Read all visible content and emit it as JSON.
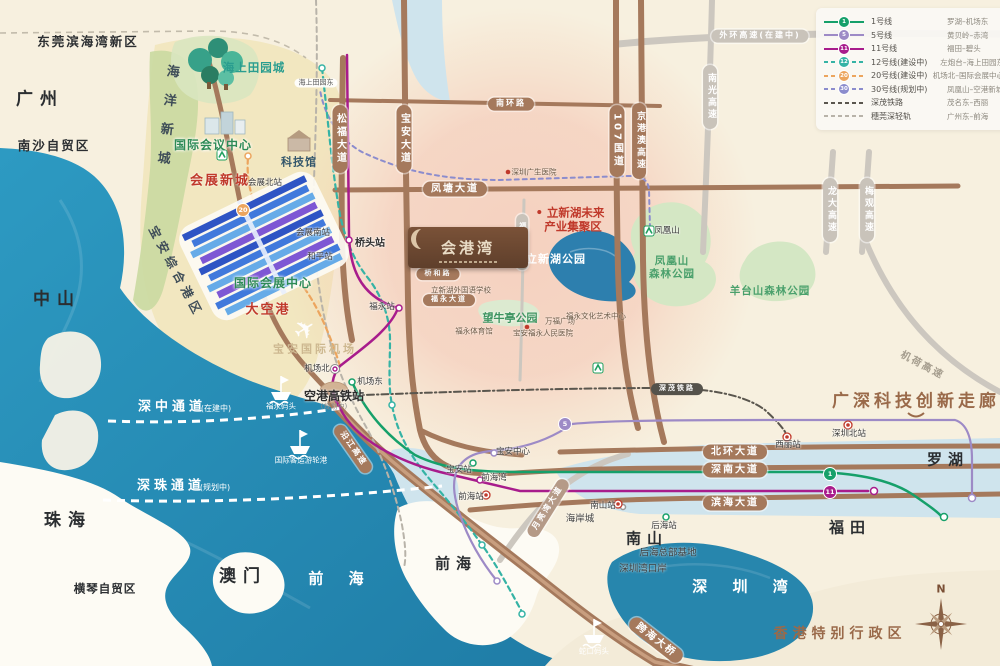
{
  "colors": {
    "sea": "#2b93bb",
    "bay": "#2786ad",
    "land": "#f7f0df",
    "road_brown": "#a5795c",
    "road_gray": "#c9c3ba",
    "pink_zone": "#f3b2a0",
    "green_zone": "#cbdaa2",
    "accent_red": "#c0392b"
  },
  "logo": {
    "title": "会港湾"
  },
  "legend": {
    "rows": [
      {
        "num": "1",
        "name": "1号线",
        "route": "罗湖–机场东",
        "color": "#16a06a",
        "dash": false
      },
      {
        "num": "5",
        "name": "5号线",
        "route": "黄贝岭–赤湾",
        "color": "#9d8ac6",
        "dash": false
      },
      {
        "num": "11",
        "name": "11号线",
        "route": "福田–碧头",
        "color": "#a81c8c",
        "dash": false
      },
      {
        "num": "12",
        "name": "12号线(建设中)",
        "route": "左炮台–海上田园东",
        "color": "#35b3a5",
        "dash": true
      },
      {
        "num": "20",
        "name": "20号线(建设中)",
        "route": "机场北–国际会展中心",
        "color": "#eca55e",
        "dash": true
      },
      {
        "num": "30",
        "name": "30号线(规划中)",
        "route": "凤凰山–空港新城",
        "color": "#8b8ccd",
        "dash": true
      },
      {
        "num": null,
        "name": "深茂铁路",
        "route": "茂名东–西丽",
        "color": "#5a564e",
        "dash": true
      },
      {
        "num": null,
        "name": "穗莞深轻轨",
        "route": "广州东–前海",
        "color": "#b8b3a9",
        "dash": true
      }
    ]
  },
  "badges": [
    {
      "n": "1",
      "x": 830,
      "y": 474,
      "c": "#16a06a"
    },
    {
      "n": "11",
      "x": 830,
      "y": 492,
      "c": "#a81c8c"
    },
    {
      "n": "5",
      "x": 565,
      "y": 424,
      "c": "#9d8ac6"
    },
    {
      "n": "20",
      "x": 243,
      "y": 210,
      "c": "#eca55e"
    }
  ],
  "pills": [
    {
      "t": "松福大道",
      "x": 340,
      "y": 139,
      "s": "brown",
      "o": "v"
    },
    {
      "t": "宝安大道",
      "x": 404,
      "y": 139,
      "s": "brown",
      "o": "v"
    },
    {
      "t": "107国道",
      "x": 617,
      "y": 141,
      "s": "brown",
      "o": "v"
    },
    {
      "t": "京港澳高速",
      "x": 639,
      "y": 141,
      "s": "brown",
      "o": "v",
      "f": 9
    },
    {
      "t": "南环路",
      "x": 511,
      "y": 104,
      "s": "brown",
      "o": "h",
      "f": 8
    },
    {
      "t": "凤塘大道",
      "x": 455,
      "y": 189,
      "s": "brown",
      "o": "h"
    },
    {
      "t": "北环大道",
      "x": 735,
      "y": 452,
      "s": "brown",
      "o": "h"
    },
    {
      "t": "深南大道",
      "x": 735,
      "y": 470,
      "s": "brown",
      "o": "h"
    },
    {
      "t": "滨海大道",
      "x": 735,
      "y": 503,
      "s": "brown",
      "o": "h"
    },
    {
      "t": "桥和路",
      "x": 438,
      "y": 274,
      "s": "brown",
      "o": "h",
      "f": 7
    },
    {
      "t": "福永大道",
      "x": 449,
      "y": 300,
      "s": "brown",
      "o": "h",
      "f": 7
    },
    {
      "t": "跨海大桥",
      "x": 656,
      "y": 640,
      "s": "brown",
      "o": "h",
      "r": 38
    },
    {
      "t": "沿江高速",
      "x": 353,
      "y": 449,
      "s": "brown",
      "o": "h",
      "r": 55,
      "f": 8
    },
    {
      "t": "外环高速(在建中)",
      "x": 760,
      "y": 36,
      "s": "gray",
      "o": "h",
      "f": 8
    },
    {
      "t": "南光高速",
      "x": 710,
      "y": 97,
      "s": "gray",
      "o": "v",
      "f": 9
    },
    {
      "t": "龙大高速",
      "x": 830,
      "y": 210,
      "s": "gray",
      "o": "v",
      "f": 9
    },
    {
      "t": "梅观高速",
      "x": 867,
      "y": 210,
      "s": "gray",
      "o": "v",
      "f": 9
    },
    {
      "t": "福洲大道",
      "x": 522,
      "y": 242,
      "s": "gray",
      "o": "v",
      "f": 7
    },
    {
      "t": "月亮湾大道",
      "x": 548,
      "y": 508,
      "s": "tan",
      "o": "h",
      "r": -58,
      "f": 8
    },
    {
      "t": "深茂铁路",
      "x": 677,
      "y": 389,
      "s": "dark",
      "o": "h",
      "f": 7
    }
  ],
  "labels": [
    {
      "t": "广州",
      "x": 40,
      "y": 100,
      "c": "city-lg"
    },
    {
      "t": "中山",
      "x": 57,
      "y": 300,
      "c": "city-lg"
    },
    {
      "t": "珠海",
      "x": 68,
      "y": 521,
      "c": "city-lg"
    },
    {
      "t": "澳门",
      "x": 243,
      "y": 577,
      "c": "city-lg"
    },
    {
      "t": "南山",
      "x": 647,
      "y": 539,
      "c": "city-md"
    },
    {
      "t": "福田",
      "x": 850,
      "y": 528,
      "c": "city-md"
    },
    {
      "t": "罗湖",
      "x": 948,
      "y": 460,
      "c": "city-md"
    },
    {
      "t": "前海",
      "x": 456,
      "y": 564,
      "c": "city-md"
    },
    {
      "t": "东莞滨海湾新区",
      "x": 88,
      "y": 42,
      "c": "city-sm"
    },
    {
      "t": "南沙自贸区",
      "x": 54,
      "y": 146,
      "c": "city-sm"
    },
    {
      "t": "横琴自贸区",
      "x": 105,
      "y": 589,
      "c": "city-xs"
    },
    {
      "t": "前 海",
      "x": 341,
      "y": 579,
      "c": "sea-lg"
    },
    {
      "t": "深 圳 湾",
      "x": 745,
      "y": 587,
      "c": "sea-lg"
    },
    {
      "t": "香港特别行政区",
      "x": 840,
      "y": 634,
      "c": "brown-lg"
    },
    {
      "t": "广深科技创新走廊",
      "x": 916,
      "y": 402,
      "c": "brown-xl"
    },
    {
      "t": "机荷高速",
      "x": 922,
      "y": 366,
      "c": "gray-rot",
      "r": 28
    },
    {
      "t": "会展新城",
      "x": 220,
      "y": 181,
      "c": "red-b"
    },
    {
      "t": "大空港",
      "x": 268,
      "y": 310,
      "c": "red-b"
    },
    {
      "t": "• 立新湖未来",
      "x": 570,
      "y": 213,
      "c": "red-s"
    },
    {
      "t": "产业集聚区",
      "x": 573,
      "y": 227,
      "c": "red-s"
    },
    {
      "t": "国际会议中心",
      "x": 213,
      "y": 145,
      "c": "green-a"
    },
    {
      "t": "国际会展中心",
      "x": 273,
      "y": 283,
      "c": "green-a"
    },
    {
      "t": "望牛亭公园",
      "x": 510,
      "y": 318,
      "c": "green-a2"
    },
    {
      "t": "凤凰山",
      "x": 672,
      "y": 261,
      "c": "park"
    },
    {
      "t": "森林公园",
      "x": 672,
      "y": 274,
      "c": "park"
    },
    {
      "t": "羊台山森林公园",
      "x": 770,
      "y": 291,
      "c": "park"
    },
    {
      "t": "海上田园城",
      "x": 254,
      "y": 68,
      "c": "teal-b"
    },
    {
      "t": "科技馆",
      "x": 299,
      "y": 162,
      "c": "tech"
    },
    {
      "t": "海洋新城",
      "x": 166,
      "y": 122,
      "c": "vert",
      "r": 6
    },
    {
      "t": "宝安综合港区",
      "x": 176,
      "y": 272,
      "c": "diag",
      "r": 62
    },
    {
      "t": "宝安国际机场",
      "x": 315,
      "y": 349,
      "c": "apt"
    },
    {
      "t": "空港高铁站",
      "x": 334,
      "y": 396,
      "c": "stn-b"
    },
    {
      "t": "(规划中)",
      "x": 334,
      "y": 407,
      "c": "tiny-g"
    },
    {
      "t": "立新湖公园",
      "x": 556,
      "y": 259,
      "c": "lake-w"
    },
    {
      "t": "海岸城",
      "x": 580,
      "y": 519,
      "c": "dark-s"
    },
    {
      "t": "后海总部基地",
      "x": 668,
      "y": 553,
      "c": "dark-s"
    },
    {
      "t": "深圳湾口岸",
      "x": 643,
      "y": 569,
      "c": "dark-s"
    },
    {
      "t": "深中通道",
      "x": 172,
      "y": 407,
      "c": "corr"
    },
    {
      "t": "(在建中)",
      "x": 216,
      "y": 409,
      "c": "corr-s"
    },
    {
      "t": "深珠通道",
      "x": 171,
      "y": 486,
      "c": "corr"
    },
    {
      "t": "(规划中)",
      "x": 215,
      "y": 488,
      "c": "corr-s"
    },
    {
      "t": "福永码头",
      "x": 281,
      "y": 406,
      "c": "wt"
    },
    {
      "t": "国际客运游轮港",
      "x": 301,
      "y": 460,
      "c": "wt"
    },
    {
      "t": "蛇口码头",
      "x": 594,
      "y": 651,
      "c": "wt"
    },
    {
      "t": "桥头站",
      "x": 370,
      "y": 244,
      "c": "stn-m"
    },
    {
      "t": "福永站",
      "x": 382,
      "y": 307,
      "c": "stn"
    },
    {
      "t": "机场北",
      "x": 317,
      "y": 369,
      "c": "stn"
    },
    {
      "t": "机场东",
      "x": 370,
      "y": 382,
      "c": "stn"
    },
    {
      "t": "会展北站",
      "x": 265,
      "y": 183,
      "c": "stn"
    },
    {
      "t": "会展南站",
      "x": 313,
      "y": 233,
      "c": "stn"
    },
    {
      "t": "和平站",
      "x": 320,
      "y": 257,
      "c": "stn"
    },
    {
      "t": "海上田园东",
      "x": 316,
      "y": 83,
      "c": "stn-pill"
    },
    {
      "t": "凤凰山",
      "x": 667,
      "y": 231,
      "c": "stn"
    },
    {
      "t": "宝安中心",
      "x": 513,
      "y": 452,
      "c": "stn"
    },
    {
      "t": "宝安站",
      "x": 459,
      "y": 470,
      "c": "stn"
    },
    {
      "t": "前海湾",
      "x": 494,
      "y": 478,
      "c": "stn"
    },
    {
      "t": "前海站",
      "x": 471,
      "y": 497,
      "c": "stn"
    },
    {
      "t": "西丽站",
      "x": 788,
      "y": 445,
      "c": "stn"
    },
    {
      "t": "深圳北站",
      "x": 849,
      "y": 434,
      "c": "stn"
    },
    {
      "t": "后海站",
      "x": 664,
      "y": 526,
      "c": "stn"
    },
    {
      "t": "南山站",
      "x": 603,
      "y": 506,
      "c": "stn"
    },
    {
      "t": "立新湖外国语学校",
      "x": 461,
      "y": 290,
      "c": "poi"
    },
    {
      "t": "福永体育馆",
      "x": 474,
      "y": 331,
      "c": "poi"
    },
    {
      "t": "宝安福永人民医院",
      "x": 543,
      "y": 333,
      "c": "poi"
    },
    {
      "t": "万福广场",
      "x": 560,
      "y": 321,
      "c": "poi"
    },
    {
      "t": "福永文化艺术中心",
      "x": 596,
      "y": 316,
      "c": "poi"
    },
    {
      "t": "深圳广生医院",
      "x": 534,
      "y": 172,
      "c": "poi"
    },
    {
      "t": "N",
      "x": 941,
      "y": 589,
      "c": "comp-n"
    }
  ]
}
